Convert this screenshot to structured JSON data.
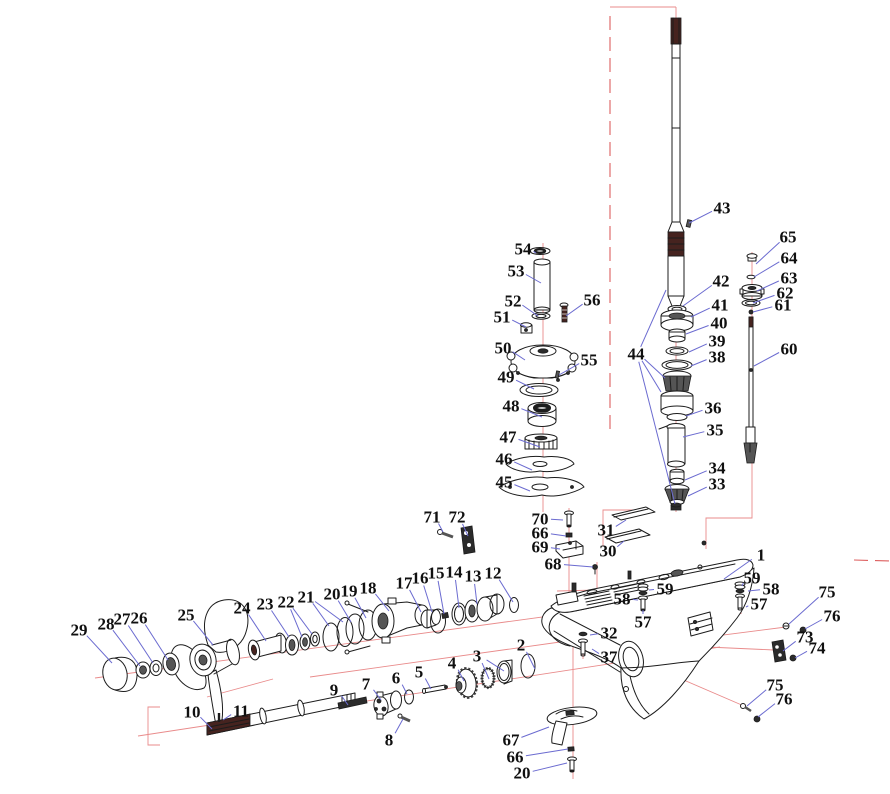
{
  "canvas": {
    "width": 890,
    "height": 794,
    "background": "#ffffff"
  },
  "colors": {
    "ink": "#1c1c1c",
    "leader": "#6b6bd0",
    "centerline": "#e98b8b",
    "boundary": "#dd5f5f",
    "label_text": "#101010"
  },
  "callouts": [
    {
      "t": "1",
      "x": 761,
      "y": 555,
      "ends": [
        [
          724,
          579
        ]
      ]
    },
    {
      "t": "2",
      "x": 521,
      "y": 645,
      "ends": [
        [
          535,
          669
        ]
      ]
    },
    {
      "t": "3",
      "x": 477,
      "y": 656,
      "ends": [
        [
          489,
          679
        ],
        [
          504,
          671
        ]
      ]
    },
    {
      "t": "4",
      "x": 452,
      "y": 663,
      "ends": [
        [
          464,
          681
        ]
      ]
    },
    {
      "t": "5",
      "x": 419,
      "y": 672,
      "ends": [
        [
          431,
          689
        ]
      ]
    },
    {
      "t": "6",
      "x": 396,
      "y": 678,
      "ends": [
        [
          407,
          694
        ]
      ]
    },
    {
      "t": "7",
      "x": 366,
      "y": 684,
      "ends": [
        [
          381,
          700
        ]
      ]
    },
    {
      "t": "8",
      "x": 389,
      "y": 740,
      "ends": [
        [
          403,
          719
        ]
      ]
    },
    {
      "t": "9",
      "x": 334,
      "y": 690,
      "ends": [
        [
          348,
          705
        ]
      ]
    },
    {
      "t": "10",
      "x": 192,
      "y": 712,
      "ends": [
        [
          212,
          729
        ]
      ]
    },
    {
      "t": "11",
      "x": 241,
      "y": 711,
      "ends": [
        [
          223,
          720
        ]
      ]
    },
    {
      "t": "12",
      "x": 493,
      "y": 573,
      "ends": [
        [
          513,
          602
        ]
      ]
    },
    {
      "t": "13",
      "x": 473,
      "y": 576,
      "ends": [
        [
          477,
          604
        ]
      ]
    },
    {
      "t": "14",
      "x": 454,
      "y": 572,
      "ends": [
        [
          459,
          608
        ]
      ]
    },
    {
      "t": "15",
      "x": 436,
      "y": 573,
      "ends": [
        [
          444,
          614
        ]
      ]
    },
    {
      "t": "16",
      "x": 420,
      "y": 578,
      "ends": [
        [
          432,
          612
        ]
      ]
    },
    {
      "t": "17",
      "x": 404,
      "y": 583,
      "ends": [
        [
          421,
          612
        ]
      ]
    },
    {
      "t": "18",
      "x": 368,
      "y": 588,
      "ends": [
        [
          389,
          611
        ]
      ]
    },
    {
      "t": "19",
      "x": 349,
      "y": 591,
      "ends": [
        [
          366,
          618
        ]
      ]
    },
    {
      "t": "20",
      "x": 332,
      "y": 594,
      "ends": [
        [
          351,
          622
        ]
      ]
    },
    {
      "t": "21",
      "x": 306,
      "y": 597,
      "ends": [
        [
          329,
          626
        ],
        [
          343,
          622
        ]
      ]
    },
    {
      "t": "22",
      "x": 286,
      "y": 602,
      "ends": [
        [
          302,
          637
        ],
        [
          312,
          634
        ]
      ]
    },
    {
      "t": "23",
      "x": 265,
      "y": 604,
      "ends": [
        [
          289,
          637
        ]
      ]
    },
    {
      "t": "24",
      "x": 242,
      "y": 608,
      "ends": [
        [
          266,
          641
        ]
      ]
    },
    {
      "t": "25",
      "x": 186,
      "y": 615,
      "ends": [
        [
          213,
          645
        ]
      ]
    },
    {
      "t": "26",
      "x": 139,
      "y": 618,
      "ends": [
        [
          168,
          660
        ]
      ]
    },
    {
      "t": "27",
      "x": 122,
      "y": 619,
      "ends": [
        [
          153,
          663
        ]
      ]
    },
    {
      "t": "28",
      "x": 106,
      "y": 624,
      "ends": [
        [
          140,
          666
        ]
      ]
    },
    {
      "t": "29",
      "x": 79,
      "y": 630,
      "ends": [
        [
          112,
          663
        ]
      ]
    },
    {
      "t": "30",
      "x": 608,
      "y": 551,
      "ends": [
        [
          624,
          541
        ]
      ]
    },
    {
      "t": "31",
      "x": 606,
      "y": 530,
      "ends": [
        [
          626,
          520
        ]
      ]
    },
    {
      "t": "32",
      "x": 609,
      "y": 633,
      "ends": [
        [
          590,
          635
        ]
      ]
    },
    {
      "t": "33",
      "x": 717,
      "y": 484,
      "ends": [
        [
          688,
          496
        ]
      ]
    },
    {
      "t": "34",
      "x": 717,
      "y": 468,
      "ends": [
        [
          685,
          480
        ]
      ]
    },
    {
      "t": "35",
      "x": 715,
      "y": 430,
      "ends": [
        [
          683,
          437
        ]
      ]
    },
    {
      "t": "36",
      "x": 713,
      "y": 408,
      "ends": [
        [
          686,
          416
        ]
      ]
    },
    {
      "t": "37",
      "x": 609,
      "y": 657,
      "ends": [
        [
          592,
          649
        ]
      ]
    },
    {
      "t": "38",
      "x": 717,
      "y": 357,
      "ends": [
        [
          691,
          366
        ]
      ]
    },
    {
      "t": "39",
      "x": 717,
      "y": 341,
      "ends": [
        [
          689,
          352
        ]
      ]
    },
    {
      "t": "40",
      "x": 719,
      "y": 323,
      "ends": [
        [
          686,
          334
        ]
      ]
    },
    {
      "t": "41",
      "x": 720,
      "y": 305,
      "ends": [
        [
          691,
          317
        ]
      ]
    },
    {
      "t": "42",
      "x": 721,
      "y": 281,
      "ends": [
        [
          683,
          306
        ]
      ]
    },
    {
      "t": "43",
      "x": 722,
      "y": 208,
      "ends": [
        [
          689,
          223
        ]
      ]
    },
    {
      "t": "44",
      "x": 636,
      "y": 354,
      "ends": [
        [
          666,
          290
        ],
        [
          665,
          378
        ],
        [
          661,
          392
        ],
        [
          675,
          504
        ]
      ]
    },
    {
      "t": "45",
      "x": 504,
      "y": 482,
      "ends": [
        [
          530,
          491
        ]
      ]
    },
    {
      "t": "46",
      "x": 504,
      "y": 459,
      "ends": [
        [
          532,
          470
        ]
      ]
    },
    {
      "t": "47",
      "x": 508,
      "y": 437,
      "ends": [
        [
          540,
          447
        ]
      ]
    },
    {
      "t": "48",
      "x": 511,
      "y": 406,
      "ends": [
        [
          542,
          417
        ]
      ]
    },
    {
      "t": "49",
      "x": 506,
      "y": 377,
      "ends": [
        [
          534,
          389
        ]
      ]
    },
    {
      "t": "50",
      "x": 503,
      "y": 348,
      "ends": [
        [
          525,
          360
        ]
      ]
    },
    {
      "t": "51",
      "x": 502,
      "y": 317,
      "ends": [
        [
          526,
          327
        ]
      ]
    },
    {
      "t": "52",
      "x": 513,
      "y": 301,
      "ends": [
        [
          538,
          316
        ]
      ]
    },
    {
      "t": "53",
      "x": 516,
      "y": 271,
      "ends": [
        [
          541,
          283
        ]
      ]
    },
    {
      "t": "54",
      "x": 523,
      "y": 249,
      "ends": [
        [
          536,
          253
        ]
      ]
    },
    {
      "t": "55",
      "x": 589,
      "y": 360,
      "ends": [
        [
          559,
          375
        ]
      ]
    },
    {
      "t": "56",
      "x": 592,
      "y": 300,
      "ends": [
        [
          566,
          316
        ]
      ]
    },
    {
      "t": "57",
      "x": 643,
      "y": 622,
      "ends": [
        [
          643,
          610
        ]
      ]
    },
    {
      "t": "58",
      "x": 622,
      "y": 599,
      "ends": [
        [
          638,
          600
        ]
      ]
    },
    {
      "t": "59",
      "x": 665,
      "y": 589,
      "ends": [
        [
          649,
          590
        ]
      ]
    },
    {
      "t": "57",
      "x": 759,
      "y": 604,
      "ends": [
        [
          746,
          607
        ]
      ]
    },
    {
      "t": "58",
      "x": 771,
      "y": 589,
      "ends": [
        [
          748,
          591
        ]
      ]
    },
    {
      "t": "59",
      "x": 752,
      "y": 578,
      "ends": [
        [
          742,
          586
        ]
      ]
    },
    {
      "t": "60",
      "x": 789,
      "y": 349,
      "ends": [
        [
          754,
          366
        ]
      ]
    },
    {
      "t": "61",
      "x": 783,
      "y": 305,
      "ends": [
        [
          753,
          312
        ]
      ]
    },
    {
      "t": "62",
      "x": 785,
      "y": 293,
      "ends": [
        [
          753,
          303
        ]
      ]
    },
    {
      "t": "63",
      "x": 789,
      "y": 278,
      "ends": [
        [
          757,
          291
        ]
      ]
    },
    {
      "t": "64",
      "x": 789,
      "y": 258,
      "ends": [
        [
          754,
          277
        ]
      ]
    },
    {
      "t": "65",
      "x": 788,
      "y": 237,
      "ends": [
        [
          756,
          264
        ]
      ]
    },
    {
      "t": "66",
      "x": 540,
      "y": 533,
      "ends": [
        [
          566,
          536
        ]
      ]
    },
    {
      "t": "67",
      "x": 511,
      "y": 740,
      "ends": [
        [
          549,
          727
        ]
      ]
    },
    {
      "t": "66",
      "x": 515,
      "y": 757,
      "ends": [
        [
          568,
          749
        ]
      ]
    },
    {
      "t": "20",
      "x": 522,
      "y": 773,
      "ends": [
        [
          567,
          763
        ]
      ]
    },
    {
      "t": "68",
      "x": 553,
      "y": 564,
      "ends": [
        [
          593,
          567
        ]
      ]
    },
    {
      "t": "69",
      "x": 540,
      "y": 547,
      "ends": [
        [
          560,
          549
        ]
      ]
    },
    {
      "t": "70",
      "x": 540,
      "y": 519,
      "ends": [
        [
          563,
          520
        ]
      ]
    },
    {
      "t": "71",
      "x": 432,
      "y": 517,
      "ends": [
        [
          443,
          532
        ]
      ]
    },
    {
      "t": "72",
      "x": 457,
      "y": 517,
      "ends": [
        [
          468,
          536
        ]
      ]
    },
    {
      "t": "73",
      "x": 805,
      "y": 637,
      "ends": [
        [
          783,
          651
        ]
      ]
    },
    {
      "t": "74",
      "x": 817,
      "y": 648,
      "ends": [
        [
          795,
          658
        ]
      ]
    },
    {
      "t": "75",
      "x": 827,
      "y": 592,
      "ends": [
        [
          789,
          624
        ]
      ]
    },
    {
      "t": "76",
      "x": 832,
      "y": 616,
      "ends": [
        [
          805,
          629
        ]
      ]
    },
    {
      "t": "75",
      "x": 775,
      "y": 685,
      "ends": [
        [
          747,
          706
        ]
      ]
    },
    {
      "t": "76",
      "x": 784,
      "y": 699,
      "ends": [
        [
          758,
          717
        ]
      ]
    }
  ]
}
